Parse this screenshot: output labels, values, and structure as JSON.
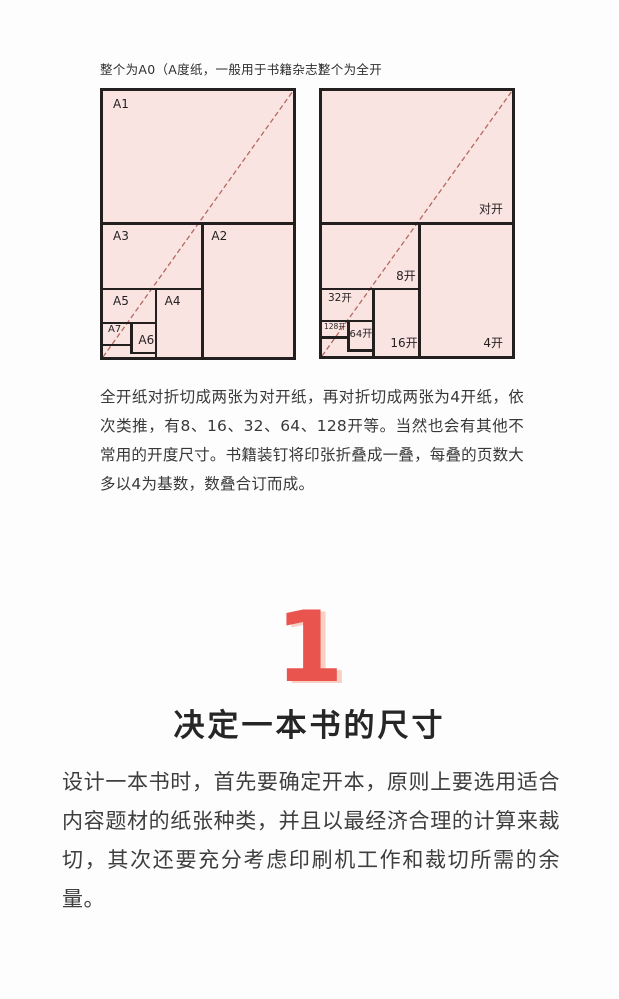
{
  "colors": {
    "page_bg": "#fdfdfd",
    "paper_fill": "#f9e4e2",
    "diagram_line": "#241f1f",
    "diagonal_line": "#b5685f",
    "accent_red": "#ea544e",
    "body_text": "#3e3e3e"
  },
  "figures": {
    "left": {
      "caption": "整个为A0（A度纸，一般用于书籍杂志）",
      "labels": [
        "A1",
        "A2",
        "A3",
        "A4",
        "A5",
        "A6",
        "A7"
      ]
    },
    "right": {
      "caption": "整个为全开",
      "labels": [
        "对开",
        "4开",
        "8开",
        "16开",
        "32开",
        "64开",
        "128开"
      ]
    }
  },
  "paragraphs": {
    "explain": "全开纸对折切成两张为对开纸，再对折切成两张为4开纸，依次类推，有8、16、32、64、128开等。当然也会有其他不常用的开度尺寸。书籍装钉将印张折叠成一叠，每叠的页数大多以4为基数，数叠合订而成。",
    "body": "设计一本书时，首先要确定开本，原则上要选用适合内容题材的纸张种类，并且以最经济合理的计算来裁切，其次还要充分考虑印刷机工作和裁切所需的余量。"
  },
  "section": {
    "number": "1",
    "title": "决定一本书的尺寸"
  }
}
